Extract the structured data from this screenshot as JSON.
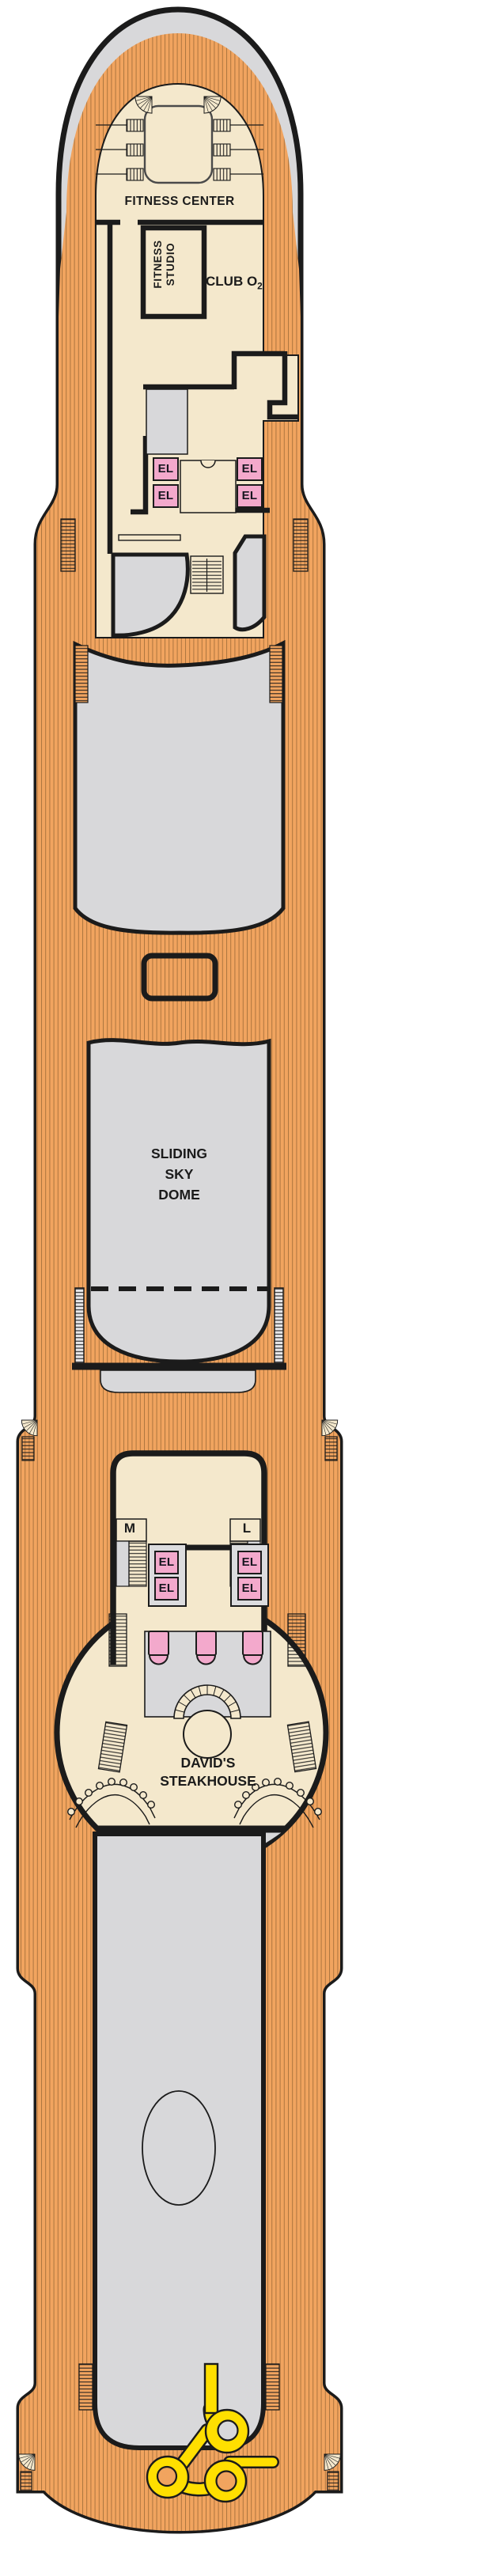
{
  "deck_plan": {
    "type": "cruise-ship-deck-plan",
    "labels": {
      "fitness_center": "FITNESS CENTER",
      "fitness_studio_line1": "FITNESS",
      "fitness_studio_line2": "STUDIO",
      "club_o2_main": "CLUB O",
      "club_o2_sub": "2",
      "sliding_sky_dome_line1": "SLIDING",
      "sliding_sky_dome_line2": "SKY",
      "sliding_sky_dome_line3": "DOME",
      "stair_m": "M",
      "stair_l": "L",
      "elevator": "EL",
      "restaurant_line1": "DAVID'S",
      "restaurant_line2": "STEAKHOUSE"
    },
    "colors": {
      "deck_wood_orange": "#F1A45F",
      "deck_plank_line": "#8F6130",
      "interior_cream": "#F4E8CC",
      "open_area_gray": "#D8D8DA",
      "elevator_pink": "#F3A9CC",
      "water_slide_yellow": "#FFDF00",
      "outline_black": "#1B1B1B"
    }
  }
}
